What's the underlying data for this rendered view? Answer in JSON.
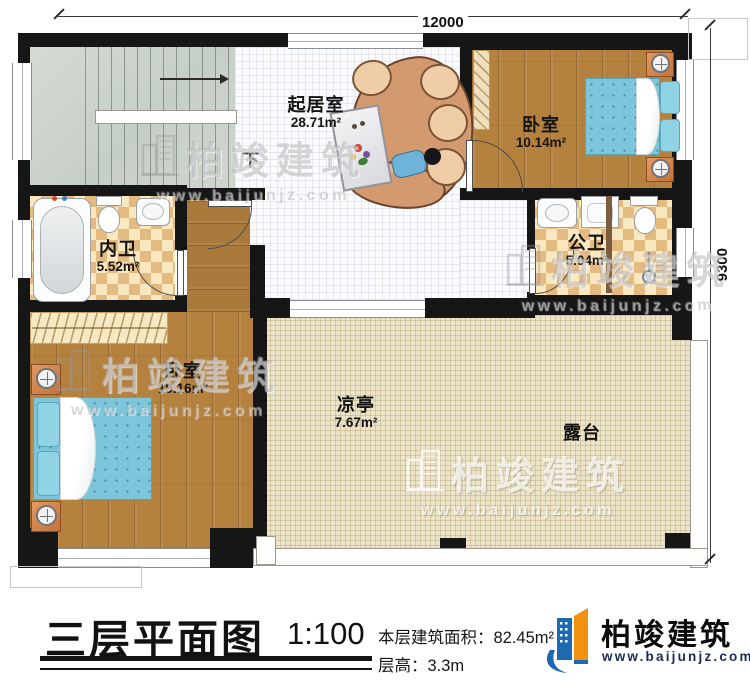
{
  "plan": {
    "dimensions": {
      "top": "12000",
      "right": "9300"
    },
    "stairs": {
      "down_label": "下"
    },
    "rooms": [
      {
        "name": "起居室",
        "area": "28.71m²"
      },
      {
        "name": "卧室",
        "area": "10.14m²"
      },
      {
        "name": "内卫",
        "area": "5.52m²"
      },
      {
        "name": "公卫",
        "area": "5.04m²"
      },
      {
        "name": "卧室",
        "area": "19.16m²"
      },
      {
        "name": "凉亭",
        "area": "7.67m²"
      },
      {
        "name": "露台",
        "area": ""
      }
    ]
  },
  "titleblock": {
    "title": "三层平面图",
    "scale": "1:100",
    "area_label": "本层建筑面积：",
    "area_value": "82.45m²",
    "height_label": "层高：",
    "height_value": "3.3m"
  },
  "brand": {
    "name": "柏竣建筑",
    "website": "www.baijunjz.com"
  },
  "watermark": {
    "name": "柏竣建筑",
    "website": "www.baijunjz.com"
  },
  "colors": {
    "wall": "#161616",
    "brand_blue": "#1d6ab2",
    "brand_orange": "#f29111",
    "bed": "#7cc5da",
    "bath_tile": "#e3ba80",
    "wood": "#b5813e",
    "terrace": "#ece4ca"
  }
}
